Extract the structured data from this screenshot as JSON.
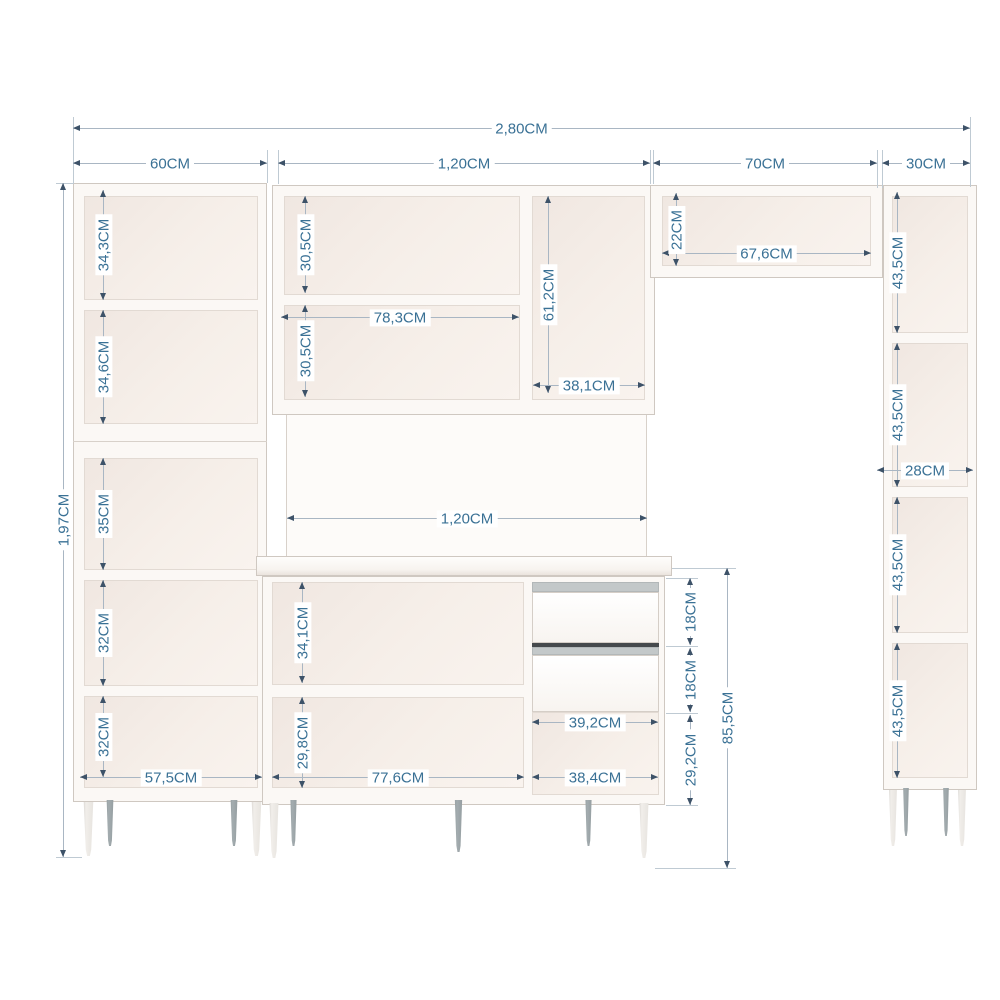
{
  "diagram": {
    "kind": "kitchen cabinet set dimension drawing",
    "units": "CM",
    "colors": {
      "dimension_text": "#3a7195",
      "dimension_line": "#a9b6c3",
      "arrow": "#3d5268",
      "furniture_edge": "#cfc8c1",
      "furniture_fill": "#fbf8f5",
      "interior_fill": "#f3eae4",
      "leg_gray": "#9aa3a6",
      "drawer_gap": "#45494c"
    }
  },
  "dims": {
    "overall_w": "2,80CM",
    "overall_h": "1,97CM",
    "top": {
      "left": "60CM",
      "middle": "1,20CM",
      "bridge": "70CM",
      "right": "30CM"
    },
    "left_cab": {
      "s1": "34,3CM",
      "s2": "34,6CM",
      "s3": "35CM",
      "s4": "32CM",
      "s5": "32CM",
      "inner_w": "57,5CM"
    },
    "upper_cab": {
      "s1": "30,5CM",
      "s2": "30,5CM",
      "left_w": "78,3CM",
      "right_h": "61,2CM",
      "right_w": "38,1CM"
    },
    "bridge": {
      "h": "22CM",
      "inner_w": "67,6CM"
    },
    "right_cab": {
      "s1": "43,5CM",
      "s2": "43,5CM",
      "s3": "43,5CM",
      "s4": "43,5CM",
      "inner_w": "28CM"
    },
    "base_cab": {
      "w": "1,20CM",
      "s1": "34,1CM",
      "s2": "29,8CM",
      "left_w": "77,6CM",
      "drawer1": "18CM",
      "drawer2": "18CM",
      "niche_w": "39,2CM",
      "niche_h": "29,2CM",
      "bottom_w": "38,4CM",
      "total_h": "85,5CM"
    }
  }
}
